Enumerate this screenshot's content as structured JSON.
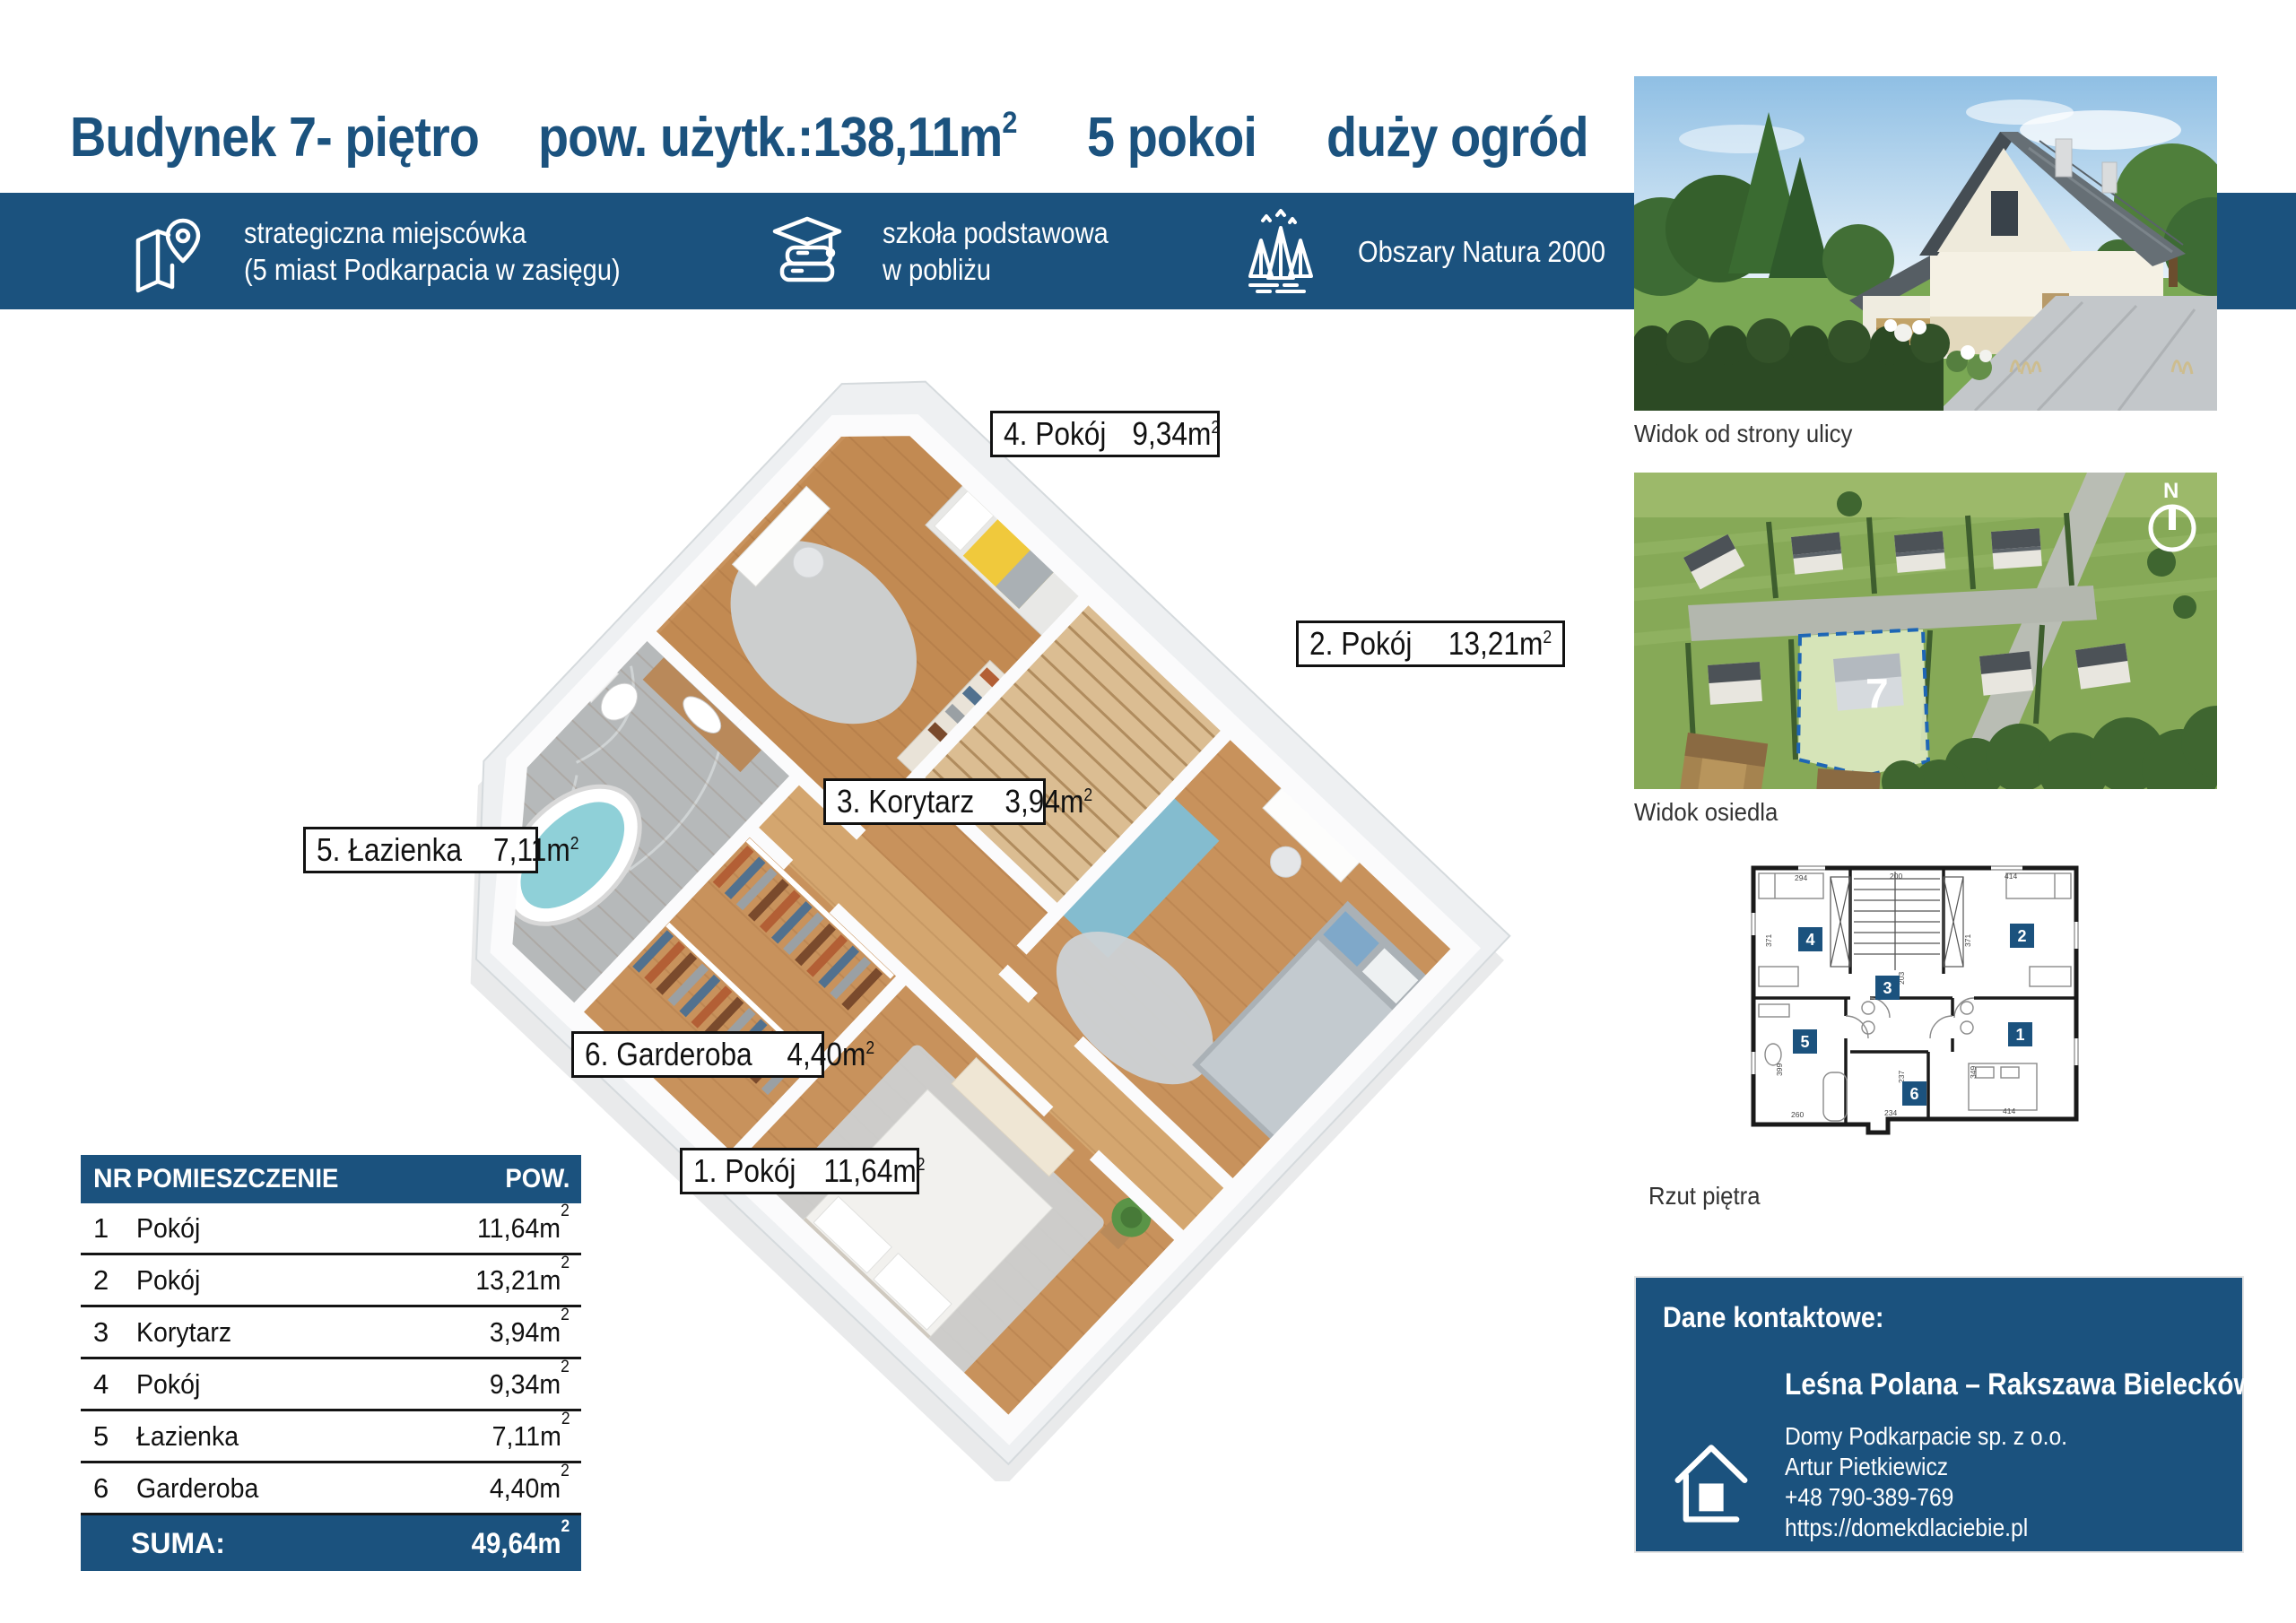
{
  "sup": "2",
  "colors": {
    "navy": "#1b527e",
    "tub_teal": "#8fd0d8",
    "accent_yellow": "#f0c93c"
  },
  "title": {
    "building": "Budynek 7- piętro",
    "area": "pow. użytk.:138,11m",
    "rooms": "5 pokoi",
    "garden": "duży ogród"
  },
  "banner": {
    "items": [
      {
        "icon": "map-location-icon",
        "line1": "strategiczna miejscówka",
        "line2": "(5 miast Podkarpacia w zasięgu)"
      },
      {
        "icon": "school-icon",
        "line1": "szkoła podstawowa",
        "line2": "w pobliżu"
      },
      {
        "icon": "forest-icon",
        "line1": "Obszary Natura 2000",
        "line2": ""
      }
    ]
  },
  "plan3d": {
    "labels": [
      {
        "name": "1. Pokój",
        "area": "11,64m"
      },
      {
        "name": "2. Pokój",
        "area": "13,21m"
      },
      {
        "name": "3. Korytarz",
        "area": "3,94m"
      },
      {
        "name": "4. Pokój",
        "area": "9,34m"
      },
      {
        "name": "5. Łazienka",
        "area": "7,11m"
      },
      {
        "name": "6. Garderoba",
        "area": "4,40m"
      }
    ]
  },
  "photos": {
    "street_caption": "Widok od strony ulicy",
    "estate_caption": "Widok osiedla",
    "plan_caption": "Rzut piętra",
    "lot_number": "7",
    "compass_letter": "N"
  },
  "plan2d": {
    "rooms": [
      "1",
      "2",
      "3",
      "4",
      "5",
      "6"
    ],
    "dims": [
      "294",
      "200",
      "414",
      "371",
      "371",
      "203",
      "399",
      "349",
      "237",
      "260",
      "234",
      "414"
    ]
  },
  "table": {
    "headers": {
      "nr": "NR",
      "room": "POMIESZCZENIE",
      "area": "POW."
    },
    "rows": [
      {
        "nr": "1",
        "room": "Pokój",
        "area": "11,64m"
      },
      {
        "nr": "2",
        "room": "Pokój",
        "area": "13,21m"
      },
      {
        "nr": "3",
        "room": "Korytarz",
        "area": "3,94m"
      },
      {
        "nr": "4",
        "room": "Pokój",
        "area": "9,34m"
      },
      {
        "nr": "5",
        "room": "Łazienka",
        "area": "7,11m"
      },
      {
        "nr": "6",
        "room": "Garderoba",
        "area": "4,40m"
      }
    ],
    "sum_label": "SUMA:",
    "sum_area": "49,64m"
  },
  "contact": {
    "heading": "Dane kontaktowe:",
    "project": "Leśna Polana – Rakszawa Bieleckówka",
    "company": "Domy Podkarpacie sp. z o.o.",
    "person": "Artur Pietkiewicz",
    "phone": "+48 790-389-769",
    "website": "https://domekdlaciebie.pl"
  }
}
